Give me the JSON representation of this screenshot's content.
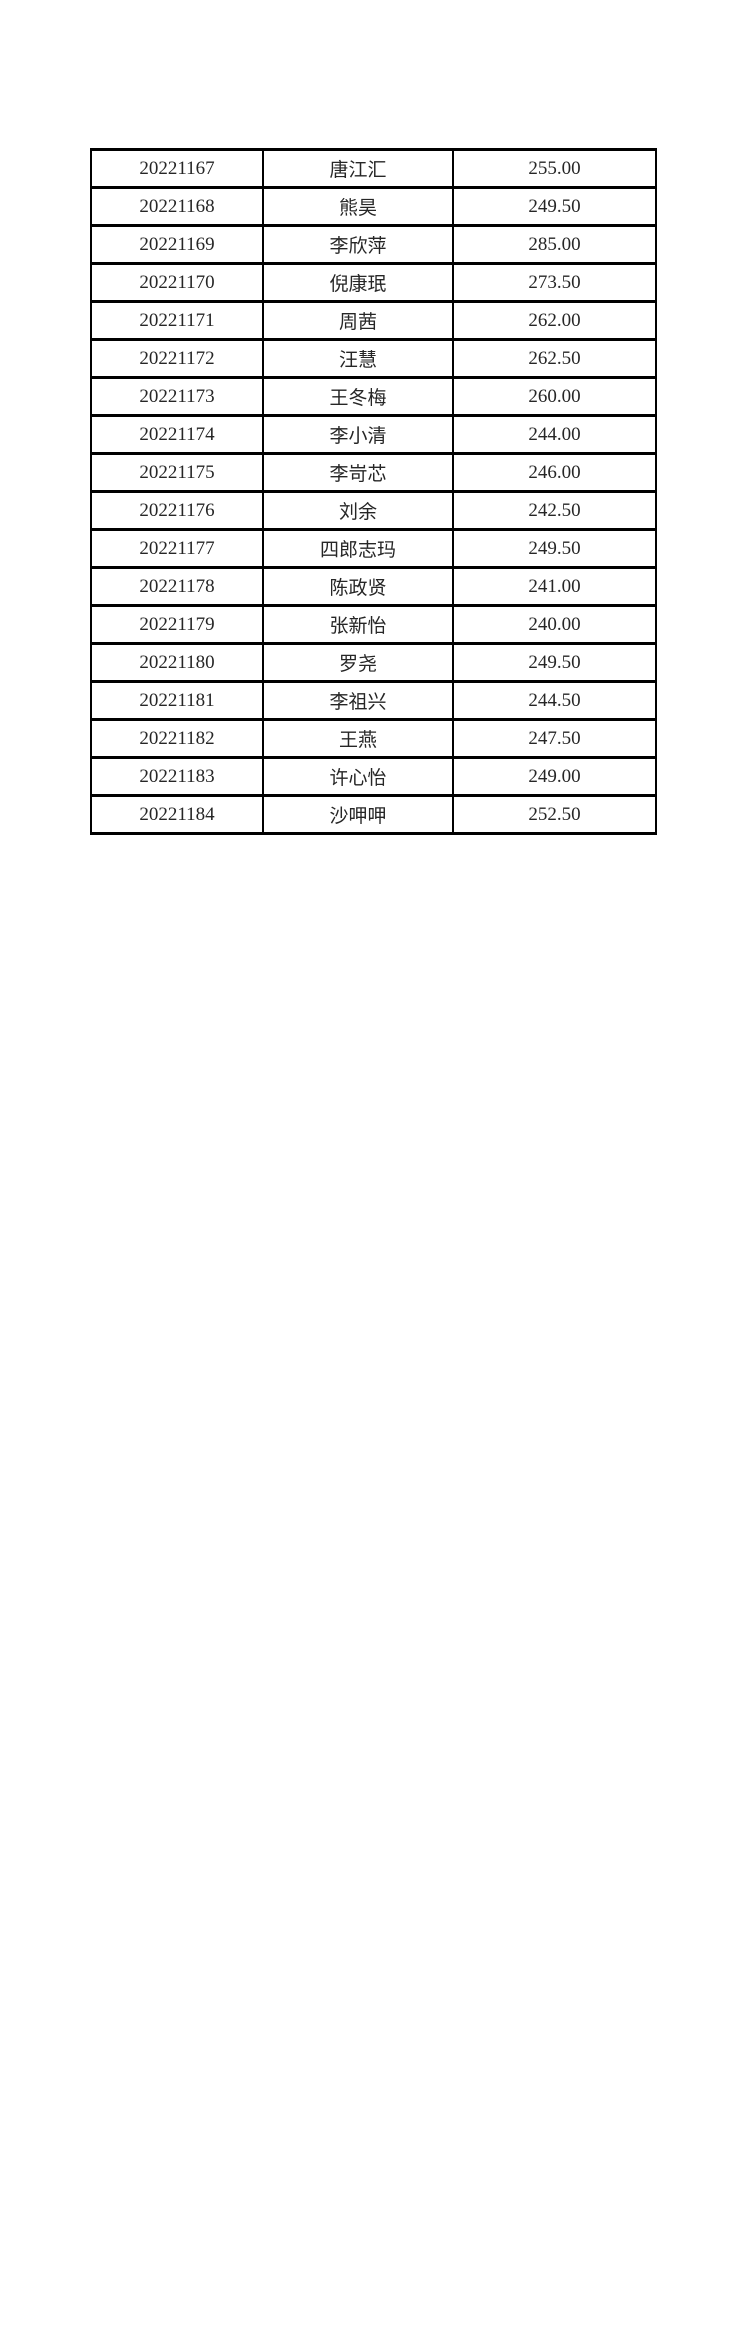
{
  "page": {
    "background_color": "#ffffff",
    "table_border_color": "#000000",
    "text_color": "#262626"
  },
  "table": {
    "columns": [
      {
        "key": "id",
        "name": "student-id-cell"
      },
      {
        "key": "name",
        "name": "student-name-cell"
      },
      {
        "key": "score",
        "name": "score-cell"
      }
    ],
    "rows": [
      {
        "id": "20221167",
        "name": "唐江汇",
        "score": "255.00"
      },
      {
        "id": "20221168",
        "name": "熊昊",
        "score": "249.50"
      },
      {
        "id": "20221169",
        "name": "李欣萍",
        "score": "285.00"
      },
      {
        "id": "20221170",
        "name": "倪康珉",
        "score": "273.50"
      },
      {
        "id": "20221171",
        "name": "周茜",
        "score": "262.00"
      },
      {
        "id": "20221172",
        "name": "汪慧",
        "score": "262.50"
      },
      {
        "id": "20221173",
        "name": "王冬梅",
        "score": "260.00"
      },
      {
        "id": "20221174",
        "name": "李小清",
        "score": "244.00"
      },
      {
        "id": "20221175",
        "name": "李岢芯",
        "score": "246.00"
      },
      {
        "id": "20221176",
        "name": "刘余",
        "score": "242.50"
      },
      {
        "id": "20221177",
        "name": "四郎志玛",
        "score": "249.50"
      },
      {
        "id": "20221178",
        "name": "陈政贤",
        "score": "241.00"
      },
      {
        "id": "20221179",
        "name": "张新怡",
        "score": "240.00"
      },
      {
        "id": "20221180",
        "name": "罗尧",
        "score": "249.50"
      },
      {
        "id": "20221181",
        "name": "李祖兴",
        "score": "244.50"
      },
      {
        "id": "20221182",
        "name": "王燕",
        "score": "247.50"
      },
      {
        "id": "20221183",
        "name": "许心怡",
        "score": "249.00"
      },
      {
        "id": "20221184",
        "name": "沙呷呷",
        "score": "252.50"
      }
    ]
  }
}
